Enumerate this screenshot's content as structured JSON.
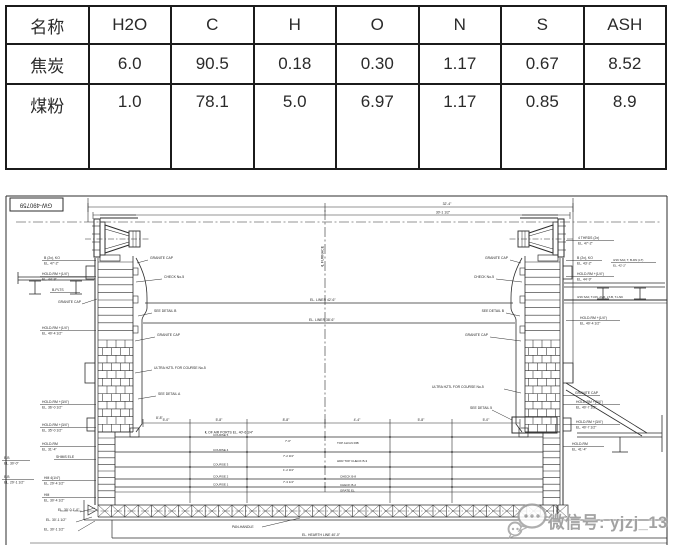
{
  "composition_table": {
    "headers": [
      "名称",
      "H2O",
      "C",
      "H",
      "O",
      "N",
      "S",
      "ASH"
    ],
    "rows": [
      {
        "name": "焦炭",
        "values": [
          "6.0",
          "90.5",
          "0.18",
          "0.30",
          "1.17",
          "0.67",
          "8.52"
        ]
      },
      {
        "name": "煤粉",
        "values": [
          "1.0",
          "78.1",
          "5.0",
          "6.97",
          "1.17",
          "0.85",
          "8.9"
        ]
      }
    ]
  },
  "drawing": {
    "sheet_number": "GW-490759",
    "ink": "#2e2e2e",
    "annotations": [
      {
        "x": 36,
        "y": 206.5,
        "t": "GW-490759",
        "a": "middle",
        "r": 180,
        "s": 6
      },
      {
        "x": 447,
        "y": 205,
        "t": "32'-4\"",
        "a": "middle"
      },
      {
        "x": 443,
        "y": 213.5,
        "t": "30'-1 1/2\"",
        "a": "middle"
      },
      {
        "x": 322,
        "y": 268,
        "t": "℄ FURNACE",
        "r": -90,
        "s": 3.6
      },
      {
        "x": 44,
        "y": 259,
        "t": "B (2x), KO",
        "ul": [
          42,
          96
        ]
      },
      {
        "x": 44,
        "y": 264.5,
        "t": "EL. 47'-2\""
      },
      {
        "x": 42,
        "y": 275,
        "t": "HOLD-RM +(1/4\")",
        "ul": [
          40,
          96
        ]
      },
      {
        "x": 42,
        "y": 280.5,
        "t": "EL. 44'-9\""
      },
      {
        "x": 52,
        "y": 291,
        "t": "B-PLTS",
        "ul": [
          50,
          80
        ]
      },
      {
        "x": 58,
        "y": 303,
        "t": "GRANITE CAP",
        "l": [
          82,
          304,
          97,
          299
        ]
      },
      {
        "x": 42,
        "y": 329,
        "t": "HOLD-RM +(1/4\")",
        "ul": [
          40,
          96
        ]
      },
      {
        "x": 42,
        "y": 334.5,
        "t": "EL. 40'-4 1/2\""
      },
      {
        "x": 42,
        "y": 403,
        "t": "HOLD-RM +(3/4\")",
        "ul": [
          40,
          96
        ]
      },
      {
        "x": 42,
        "y": 408.5,
        "t": "EL. 36'-0 1/2\""
      },
      {
        "x": 42,
        "y": 426,
        "t": "HOLD-RM +(3/4\")",
        "ul": [
          40,
          96
        ]
      },
      {
        "x": 42,
        "y": 431.5,
        "t": "EL. 35'-0 1/2\""
      },
      {
        "x": 42,
        "y": 445,
        "t": "HOLD-RM",
        "ul": [
          40,
          96
        ]
      },
      {
        "x": 42,
        "y": 450.5,
        "t": "EL. 31'-4\""
      },
      {
        "x": 4,
        "y": 459,
        "t": "B.B",
        "ul": [
          2,
          30
        ]
      },
      {
        "x": 4,
        "y": 464.5,
        "t": "EL. 30'-0\""
      },
      {
        "x": 56,
        "y": 458,
        "t": "SHIMS ELE",
        "ul": [
          54,
          96
        ]
      },
      {
        "x": 4,
        "y": 478,
        "t": "B.B",
        "ul": [
          2,
          34
        ]
      },
      {
        "x": 4,
        "y": 483.5,
        "t": "EL. 29'-1 1/2\""
      },
      {
        "x": 44,
        "y": 479,
        "t": "HM 4(1/4\")",
        "ul": [
          42,
          96
        ]
      },
      {
        "x": 44,
        "y": 484.5,
        "t": "EL. 29'-4 1/2\""
      },
      {
        "x": 44,
        "y": 496,
        "t": "HM",
        "ul": [
          42,
          96
        ]
      },
      {
        "x": 44,
        "y": 501.5,
        "t": "EL. 30'-4 1/2\""
      },
      {
        "x": 58,
        "y": 511,
        "t": "EL. 30'-0-1'-0\"",
        "l": [
          80,
          512,
          95,
          508
        ]
      },
      {
        "x": 46,
        "y": 521,
        "t": "EL. 30'-1 1/2\"",
        "l": [
          76,
          522,
          92,
          517
        ]
      },
      {
        "x": 44,
        "y": 530.5,
        "t": "EL. 30'-1 1/2\"",
        "l": [
          78,
          531,
          95,
          521
        ]
      },
      {
        "x": 150,
        "y": 259,
        "t": "GRANITE CAP",
        "l": [
          148,
          260,
          137,
          263
        ]
      },
      {
        "x": 164,
        "y": 278,
        "t": "CHECK No-5",
        "l": [
          162,
          279,
          136,
          282
        ]
      },
      {
        "x": 154,
        "y": 312,
        "t": "SEE DETAIL B",
        "l": [
          152,
          313,
          138,
          316
        ]
      },
      {
        "x": 157,
        "y": 336,
        "t": "GRANITE CAP",
        "l": [
          155,
          337,
          135,
          341
        ]
      },
      {
        "x": 154,
        "y": 369,
        "t": "ULTRA HZTL FOR COURSE No-5",
        "l": [
          152,
          370,
          135,
          373
        ]
      },
      {
        "x": 158,
        "y": 395,
        "t": "SEE DETAIL A",
        "l": [
          156,
          396,
          138,
          399
        ]
      },
      {
        "x": 156,
        "y": 419,
        "t": "8'-8\""
      },
      {
        "x": 508,
        "y": 259,
        "t": "GRANITE CAP",
        "a": "end",
        "l": [
          510,
          260,
          521,
          263
        ]
      },
      {
        "x": 494,
        "y": 278,
        "t": "CHECK No-5",
        "a": "end",
        "l": [
          496,
          279,
          522,
          282
        ]
      },
      {
        "x": 504,
        "y": 312,
        "t": "SEE DETAIL B",
        "a": "end",
        "l": [
          506,
          313,
          520,
          316
        ]
      },
      {
        "x": 488,
        "y": 336,
        "t": "GRANITE CAP",
        "a": "end",
        "l": [
          490,
          337,
          521,
          341
        ]
      },
      {
        "x": 432,
        "y": 388,
        "t": "ULTRA HZTL FOR COURSE No-5",
        "l": [
          504,
          389,
          521,
          393
        ]
      },
      {
        "x": 470,
        "y": 409,
        "t": "SEE DETAIL 5",
        "l": [
          492,
          410,
          512,
          420
        ]
      },
      {
        "x": 310,
        "y": 301,
        "t": "EL. LINER 42'-6\""
      },
      {
        "x": 309,
        "y": 321,
        "t": "EL. LINER 38'-6\""
      },
      {
        "x": 205,
        "y": 433.5,
        "t": "℄ OF AIR PORTS EL. 40'-6 1/4\""
      },
      {
        "x": 166,
        "y": 421,
        "t": "5'-0\"",
        "a": "middle"
      },
      {
        "x": 219,
        "y": 421,
        "t": "5'-8\"",
        "a": "middle"
      },
      {
        "x": 286,
        "y": 421,
        "t": "8'-8\"",
        "a": "middle"
      },
      {
        "x": 357,
        "y": 421,
        "t": "4'-4\"",
        "a": "middle"
      },
      {
        "x": 421,
        "y": 421,
        "t": "5'-8\"",
        "a": "middle"
      },
      {
        "x": 486,
        "y": 421,
        "t": "5'-0\"",
        "a": "middle"
      },
      {
        "x": 213,
        "y": 436,
        "t": "COURSE 5",
        "s": 3
      },
      {
        "x": 213,
        "y": 451,
        "t": "COURSE 4",
        "s": 3
      },
      {
        "x": 213,
        "y": 465.5,
        "t": "COURSE 3",
        "s": 3
      },
      {
        "x": 213,
        "y": 477.5,
        "t": "COURSE 2",
        "s": 3
      },
      {
        "x": 213,
        "y": 485.5,
        "t": "COURSE 1",
        "s": 3
      },
      {
        "x": 285,
        "y": 442,
        "t": "7'-0\"",
        "s": 3
      },
      {
        "x": 283,
        "y": 457,
        "t": "7'-2 3/4\"",
        "s": 3
      },
      {
        "x": 283,
        "y": 471,
        "t": "1'-2 3/4\"",
        "s": 3
      },
      {
        "x": 283,
        "y": 483,
        "t": "7'-3 1/4\"",
        "s": 3
      },
      {
        "x": 337,
        "y": 444,
        "t": "TOP ALIGN RIB",
        "s": 3
      },
      {
        "x": 337,
        "y": 462,
        "t": "HDR TOP CHECK B-3",
        "s": 3
      },
      {
        "x": 340,
        "y": 477.5,
        "t": "CHECK B-8",
        "s": 3
      },
      {
        "x": 340,
        "y": 486,
        "t": "CHECK B-2",
        "s": 3
      },
      {
        "x": 340,
        "y": 491.5,
        "t": "GRATE EL",
        "s": 3
      },
      {
        "x": 232,
        "y": 528,
        "t": "PAN-HANDLE",
        "l": [
          262,
          527,
          300,
          518
        ]
      },
      {
        "x": 302,
        "y": 536,
        "t": "EL. HEARTH LINE 40'-0\""
      },
      {
        "x": 578,
        "y": 239,
        "t": "4 THRDS (2x)",
        "ul": [
          566,
          614
        ]
      },
      {
        "x": 578,
        "y": 244.5,
        "t": "EL. 47'-2\""
      },
      {
        "x": 577,
        "y": 259,
        "t": "B (2x), KO",
        "ul": [
          566,
          602
        ]
      },
      {
        "x": 577,
        "y": 264.5,
        "t": "EL. 43'-2\""
      },
      {
        "x": 613,
        "y": 261,
        "t": "3/16 SAF, T, B-DN (LT)",
        "s": 3,
        "ul": [
          611,
          656
        ]
      },
      {
        "x": 613,
        "y": 266.5,
        "t": "EL. 42'-2\"",
        "s": 3
      },
      {
        "x": 577,
        "y": 275,
        "t": "HOLD-RM +(1/4\")",
        "ul": [
          566,
          614
        ]
      },
      {
        "x": 577,
        "y": 280.5,
        "t": "EL. 44'-9\""
      },
      {
        "x": 577,
        "y": 298,
        "t": "3/16 SAF, T-DN, AVR, LT-B, T-LNK",
        "s": 3
      },
      {
        "x": 580,
        "y": 319,
        "t": "HOLD-RM +(1/4\")",
        "ul": [
          566,
          620
        ]
      },
      {
        "x": 580,
        "y": 324.5,
        "t": "EL. 40'-4 1/2\""
      },
      {
        "x": 575,
        "y": 394,
        "t": "GRANITE CAP",
        "ul": [
          563,
          600
        ]
      },
      {
        "x": 576,
        "y": 403,
        "t": "HOLD-RM +(3/4\")",
        "ul": [
          563,
          620
        ]
      },
      {
        "x": 576,
        "y": 408.5,
        "t": "EL. 40'-7 1/2\""
      },
      {
        "x": 576,
        "y": 423,
        "t": "HOLD-RM +(3/4\")",
        "ul": [
          563,
          620
        ]
      },
      {
        "x": 576,
        "y": 428.5,
        "t": "EL. 40'-7 1/2\""
      },
      {
        "x": 572,
        "y": 445,
        "t": "HOLD-RM",
        "ul": [
          563,
          604
        ]
      },
      {
        "x": 572,
        "y": 450.5,
        "t": "EL. 41'-4\""
      }
    ]
  },
  "watermark": {
    "label": "微信号: yjzj_13",
    "color": "#a2a2a2"
  }
}
